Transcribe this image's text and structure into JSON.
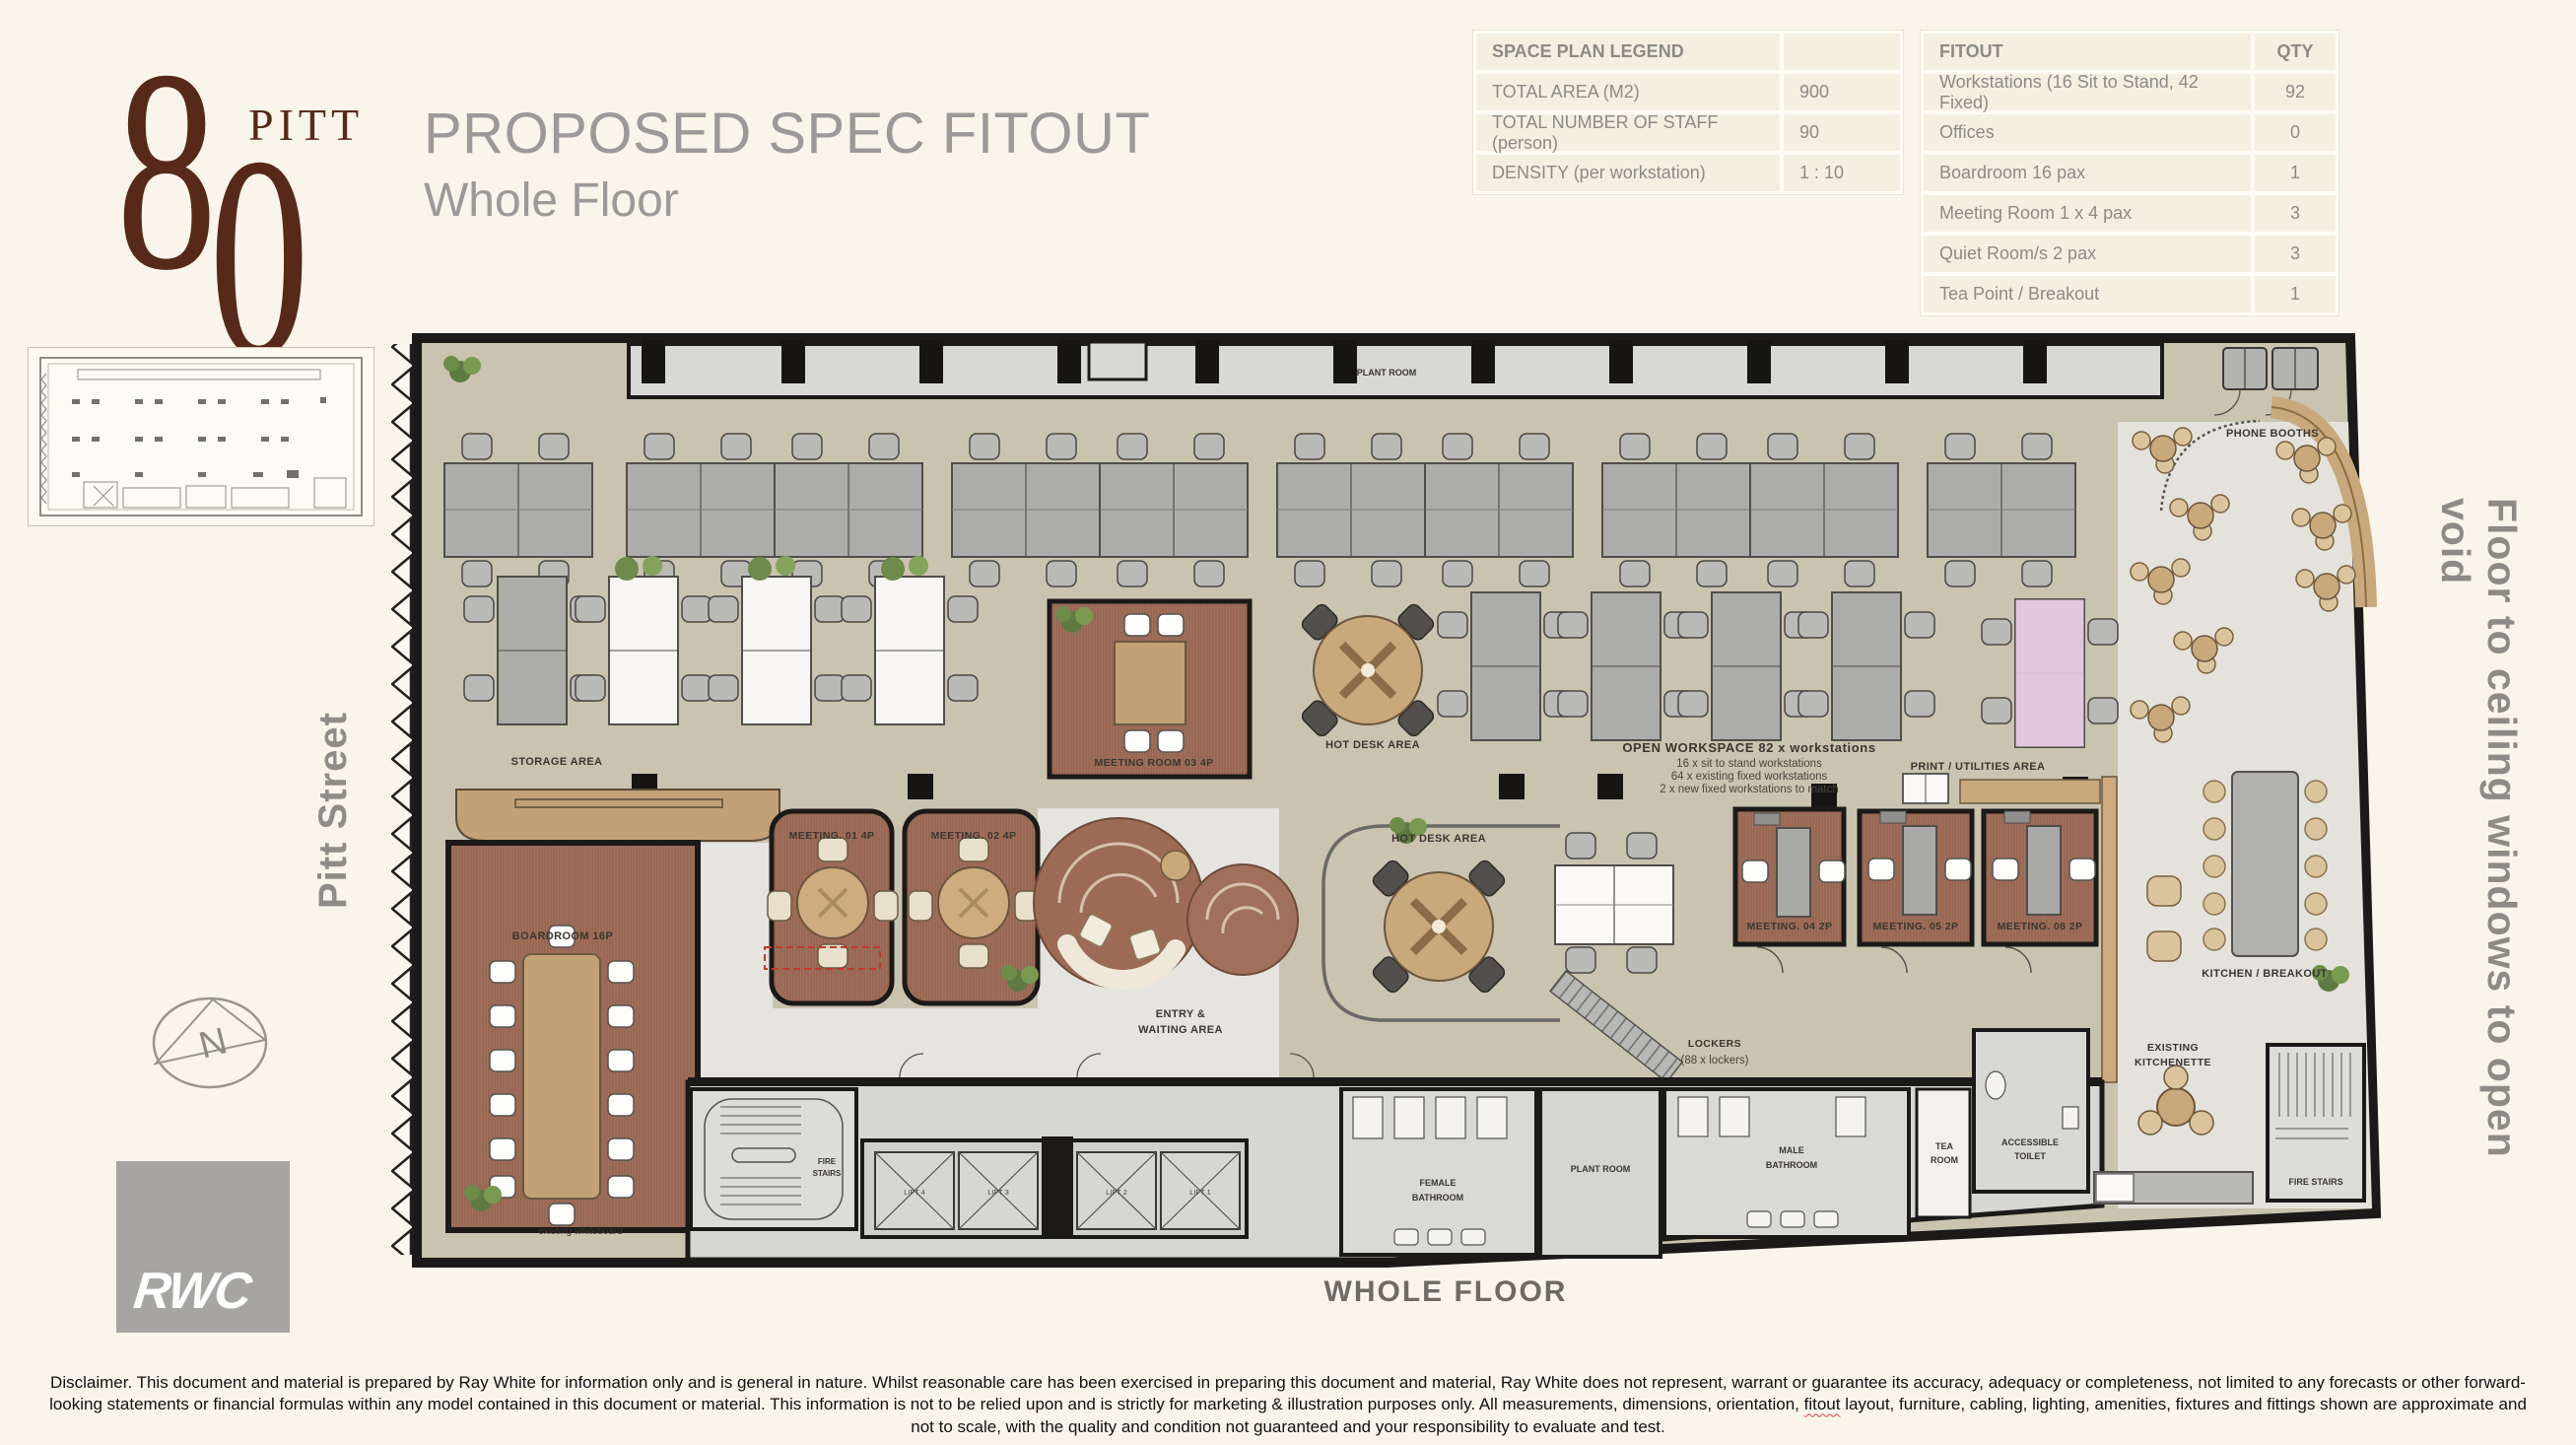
{
  "logo": {
    "digit_top": "8",
    "digit_bottom": "0",
    "name": "PITT"
  },
  "header": {
    "title": "PROPOSED SPEC FITOUT",
    "subtitle": "Whole Floor"
  },
  "legend_table": {
    "header": "SPACE PLAN LEGEND",
    "rows": [
      {
        "label": "TOTAL AREA (M2)",
        "value": "900"
      },
      {
        "label": "TOTAL NUMBER OF STAFF (person)",
        "value": "90"
      },
      {
        "label": "DENSITY (per workstation)",
        "value": "1 : 10"
      }
    ]
  },
  "fitout_table": {
    "header_label": "FITOUT",
    "header_qty": "QTY",
    "rows": [
      {
        "label": "Workstations (16 Sit to Stand, 42 Fixed)",
        "qty": "92"
      },
      {
        "label": "Offices",
        "qty": "0"
      },
      {
        "label": "Boardroom 16 pax",
        "qty": "1"
      },
      {
        "label": "Meeting Room 1 x 4 pax",
        "qty": "3"
      },
      {
        "label": "Quiet Room/s 2 pax",
        "qty": "3"
      },
      {
        "label": "Tea Point / Breakout",
        "qty": "1"
      }
    ]
  },
  "side_labels": {
    "left": "Pitt Street",
    "right": "Floor to ceiling windows to open void"
  },
  "compass": {
    "letter": "N"
  },
  "rwc_logo": "RWC",
  "plan": {
    "caption": "WHOLE FLOOR",
    "labels": {
      "plant_room": "PLANT ROOM",
      "phone_booths": "PHONE BOOTHS",
      "storage_area": "STORAGE AREA",
      "boardroom": "BOARDROOM 16P",
      "meeting_01": "MEETING. 01 4P",
      "meeting_02": "MEETING. 02 4P",
      "meeting_03": "MEETING ROOM 03 4P",
      "hot_desk_area_1": "HOT DESK AREA",
      "hot_desk_area_2": "HOT DESK AREA",
      "open_workspace_title": "OPEN WORKSPACE 82 x workstations",
      "open_workspace_line1": "16 x sit to stand workstations",
      "open_workspace_line2": "64 x existing fixed workstations",
      "open_workspace_line3": "2 x new fixed workstations to match",
      "print_utilities": "PRINT / UTILITIES AREA",
      "meeting_04": "MEETING. 04 2P",
      "meeting_05": "MEETING. 05 2P",
      "meeting_06": "MEETING. 06 2P",
      "kitchen_breakout": "KITCHEN / BREAKOUT",
      "entry_line1": "ENTRY &",
      "entry_line2": "WAITING AREA",
      "lockers_line1": "LOCKERS",
      "lockers_line2": "(88 x lockers)",
      "existing_kitchenette_line1": "EXISTING",
      "existing_kitchenette_line2": "KITCHENETTE",
      "accessible_toilet_line1": "ACCESSIBLE",
      "accessible_toilet_line2": "TOILET",
      "tea_room_line1": "TEA",
      "tea_room_line2": "ROOM",
      "male_bathroom_line1": "MALE",
      "male_bathroom_line2": "BATHROOM",
      "female_bathroom_line1": "FEMALE",
      "female_bathroom_line2": "BATHROOM",
      "plant_room_core": "PLANT ROOM",
      "fire_stairs_left_line1": "FIRE",
      "fire_stairs_left_line2": "STAIRS",
      "fire_stairs_right": "FIRE STAIRS",
      "lift_1": "LIFT 1",
      "lift_2": "LIFT 2",
      "lift_3": "LIFT 3",
      "lift_4": "LIFT 4",
      "existing_whiteboard": "existing whiteboard"
    }
  },
  "disclaimer": {
    "part1": "Disclaimer. This document and material is prepared by Ray White for information only and is general in nature.  Whilst reasonable care has been exercised in preparing this document and material,  Ray White does not represent, warrant or guarantee its accuracy, adequacy or completeness, not limited to any forecasts or other forward-looking statements or financial formulas within any model contained in this document or material. This information is not to be relied upon and is strictly for marketing & illustration purposes only. All measurements, dimensions, orientation, ",
    "word_fitout": "fitout",
    "part2": " layout, furniture, cabling, lighting, amenities, fixtures and fittings shown are approximate and not to scale, with the quality and condition not guaranteed and your responsibility to evaluate and test."
  },
  "colors": {
    "brand_maroon": "#57291a",
    "title_gray": "#9c9a98",
    "page_cream": "#faf5ea",
    "floor_tan": "#cac3b0",
    "carpet_brown": "#a1705c",
    "wall_black": "#1b1a18"
  }
}
